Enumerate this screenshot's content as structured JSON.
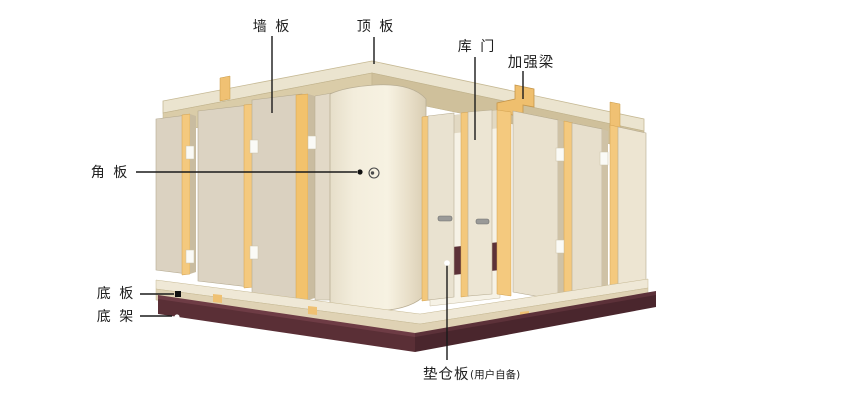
{
  "diagram": {
    "type": "cold-storage-room-structure-diagram",
    "labels": {
      "wall_panel": "墙 板",
      "top_panel": "顶 板",
      "door": "库 门",
      "reinforcement_beam": "加强梁",
      "corner_panel": "角 板",
      "bottom_panel": "底 板",
      "bottom_frame": "底 架",
      "pallet": "垫仓板",
      "pallet_note": "(用户自备)"
    },
    "colors": {
      "background": "#FFFFFF",
      "roof_top": "#EBE4CF",
      "roof_edge_band": "#D6C8A4",
      "panel_cream": "#DCD3C2",
      "panel_light": "#EFE9D7",
      "gold_strip": "#F3C87C",
      "base_frame_maroon": "#5A2F36",
      "leader_line": "#1A1A1A"
    }
  }
}
